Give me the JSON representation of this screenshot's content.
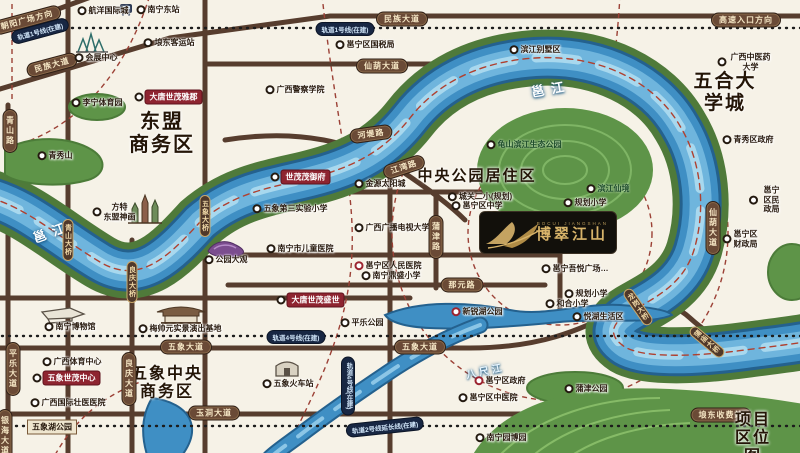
{
  "map": {
    "title": "项目区位图",
    "logo": {
      "sub": "BOCUI JIANGSHAN",
      "title": "博翠江山"
    },
    "colors": {
      "river": "#3f8fc4",
      "bank_green": "#4f7a3a",
      "road_brown": "#573d2e",
      "metro_navy": "#182743",
      "project_red": "#8e2430",
      "dash_maroon": "#9c4136",
      "logo_gold": "#d8b46a",
      "paper": "#f6f2e7"
    },
    "labels": [
      {
        "n": "pill-chaoyang-square-direction",
        "t": "朝阳广场方向",
        "x": 27,
        "y": 20,
        "k": "roadpill",
        "ro": -15
      },
      {
        "n": "pill-metro-line1-a",
        "t": "轨道1号线(在建)",
        "x": 40,
        "y": 31,
        "k": "navypill",
        "ro": -15
      },
      {
        "n": "poi-hangyang-intl-city",
        "t": "航洋国际城",
        "x": 103,
        "y": 11,
        "k": "poi"
      },
      {
        "n": "poi-nanning-east-station",
        "t": "南宁东站",
        "x": 158,
        "y": 10,
        "k": "poi"
      },
      {
        "n": "pill-minzu-avenue-a",
        "t": "民族大道",
        "x": 52,
        "y": 65,
        "k": "roadpill",
        "ro": -15
      },
      {
        "n": "poi-langdong-bus-station",
        "t": "埌东客运站",
        "x": 169,
        "y": 43,
        "k": "poi"
      },
      {
        "n": "poi-convention-center",
        "t": "会展中心",
        "x": 96,
        "y": 58,
        "k": "poi"
      },
      {
        "n": "pill-qingshan-road",
        "t": "青山路",
        "x": 10,
        "y": 131,
        "k": "roadpill-v"
      },
      {
        "n": "poi-qingxiu-mountain",
        "t": "青秀山",
        "x": 55,
        "y": 156,
        "k": "poi"
      },
      {
        "n": "poi-lining-sports-park",
        "t": "李宁体育园",
        "x": 97,
        "y": 103,
        "k": "poi"
      },
      {
        "n": "project-datang-shimao-yajun",
        "t": "大唐世茂雅郡",
        "x": 168,
        "y": 97,
        "k": "redbox"
      },
      {
        "n": "area-dongmeng-business-district",
        "t": "东盟\n商务区",
        "x": 162,
        "y": 134,
        "k": "big",
        "s": 20
      },
      {
        "n": "pill-metro-line1-b",
        "t": "轨道1号线(在建)",
        "x": 345,
        "y": 29,
        "k": "navypill"
      },
      {
        "n": "pill-minzu-avenue-b",
        "t": "民族大道",
        "x": 402,
        "y": 19,
        "k": "roadpill"
      },
      {
        "n": "poi-yongning-tax-bureau",
        "t": "邕宁区国税局",
        "x": 365,
        "y": 45,
        "k": "poi"
      },
      {
        "n": "poi-binjiang-villa-area",
        "t": "滨江别墅区",
        "x": 535,
        "y": 50,
        "k": "poi"
      },
      {
        "n": "pill-highway-entrance-direction",
        "t": "高速入口方向",
        "x": 746,
        "y": 20,
        "k": "roadpill"
      },
      {
        "n": "poi-gx-tcm-university",
        "t": "广西中医药大学",
        "x": 745,
        "y": 62,
        "k": "poi"
      },
      {
        "n": "area-wuhe-university-town",
        "t": "五合大学城",
        "x": 725,
        "y": 93,
        "k": "big",
        "s": 19
      },
      {
        "n": "poi-qingxiu-district-gov",
        "t": "青秀区政府",
        "x": 748,
        "y": 140,
        "k": "poi"
      },
      {
        "n": "pill-xianhu-avenue-h",
        "t": "仙葫大道",
        "x": 382,
        "y": 66,
        "k": "roadpill"
      },
      {
        "n": "poi-gx-police-college",
        "t": "广西警察学院",
        "x": 295,
        "y": 90,
        "k": "poi"
      },
      {
        "n": "river-label-yongjiang-a",
        "t": "邕江",
        "x": 52,
        "y": 231,
        "k": "river",
        "ro": -20
      },
      {
        "n": "river-label-yongjiang-b",
        "t": "邕江",
        "x": 551,
        "y": 88,
        "k": "river",
        "ro": -10
      },
      {
        "n": "bridge-qingshan",
        "t": "青山大桥",
        "x": 68,
        "y": 240,
        "k": "bridge"
      },
      {
        "n": "bridge-wuxiang",
        "t": "五象大桥",
        "x": 205,
        "y": 216,
        "k": "bridge"
      },
      {
        "n": "bridge-liangqing",
        "t": "良庆大桥",
        "x": 132,
        "y": 282,
        "k": "bridge"
      },
      {
        "n": "poi-fangte-asean-legend",
        "t": "方特\n东盟神画",
        "x": 114,
        "y": 212,
        "k": "poi"
      },
      {
        "n": "poi-jinyuan-sun-city",
        "t": "金源太阳城",
        "x": 380,
        "y": 184,
        "k": "poi"
      },
      {
        "n": "project-shimao-maoyufu",
        "t": "世茂茂御府",
        "x": 300,
        "y": 177,
        "k": "redbox"
      },
      {
        "n": "poi-wuxiang-no3-experimental-primary",
        "t": "五象第三实验小学",
        "x": 290,
        "y": 209,
        "k": "poi"
      },
      {
        "n": "area-central-park-residential",
        "t": "中央公园居住区",
        "x": 477,
        "y": 177,
        "k": "big",
        "s": 15
      },
      {
        "n": "poi-chengguan-2nd-primary",
        "t": "城关二小(规划)",
        "x": 480,
        "y": 197,
        "k": "poi"
      },
      {
        "n": "poi-yongning-middle-school",
        "t": "邕宁区中学",
        "x": 477,
        "y": 206,
        "k": "poi"
      },
      {
        "n": "poi-planned-school-1",
        "t": "规划小学",
        "x": 585,
        "y": 203,
        "k": "poi"
      },
      {
        "n": "poi-binjiang-scenic",
        "t": "滨江仙境",
        "x": 608,
        "y": 189,
        "k": "green"
      },
      {
        "n": "poi-guishan-riverside-eco-park",
        "t": "龟山滨江生态公园",
        "x": 524,
        "y": 145,
        "k": "green"
      },
      {
        "n": "poi-gx-broadcast-tv-university",
        "t": "广西广播电视大学",
        "x": 392,
        "y": 228,
        "k": "poi"
      },
      {
        "n": "poi-gongyuan-daguan",
        "t": "公园大观",
        "x": 226,
        "y": 260,
        "k": "poi"
      },
      {
        "n": "poi-children-hospital",
        "t": "南宁市儿童医院",
        "x": 300,
        "y": 249,
        "k": "poi"
      },
      {
        "n": "poi-yongning-people-hospital",
        "t": "邕宁区人民医院",
        "x": 388,
        "y": 266,
        "k": "poi",
        "r": "red"
      },
      {
        "n": "poi-dingsheng-primary",
        "t": "南宁鼎盛小学",
        "x": 391,
        "y": 276,
        "k": "poi"
      },
      {
        "n": "poi-yongning-wuyue-plaza",
        "t": "邕宁吾悦广场…",
        "x": 575,
        "y": 269,
        "k": "poi"
      },
      {
        "n": "poi-yongning-civil-affairs",
        "t": "邕宁区民政局",
        "x": 766,
        "y": 200,
        "k": "poi"
      },
      {
        "n": "poi-yongning-finance-bureau",
        "t": "邕宁区\n财政局",
        "x": 740,
        "y": 239,
        "k": "poi"
      },
      {
        "n": "pill-jiangwan-road",
        "t": "江湾路",
        "x": 404,
        "y": 167,
        "k": "roadpill",
        "ro": -18
      },
      {
        "n": "pill-hedi-road",
        "t": "河堤路",
        "x": 371,
        "y": 134,
        "k": "roadpill",
        "ro": -8
      },
      {
        "n": "pill-xianhu-avenue-v",
        "t": "仙葫大道",
        "x": 713,
        "y": 228,
        "k": "roadpill-v"
      },
      {
        "n": "pill-pujin-road",
        "t": "蒲津路",
        "x": 436,
        "y": 237,
        "k": "roadpill-v"
      },
      {
        "n": "pill-nayuan-road",
        "t": "那元路",
        "x": 462,
        "y": 285,
        "k": "roadpill"
      },
      {
        "n": "poi-planned-school-2",
        "t": "规划小学",
        "x": 586,
        "y": 294,
        "k": "poi"
      },
      {
        "n": "poi-hehe-primary",
        "t": "和合小学",
        "x": 567,
        "y": 304,
        "k": "poi"
      },
      {
        "n": "pill-metro-line4",
        "t": "轨道4号线(在建)",
        "x": 296,
        "y": 337,
        "k": "navypill"
      },
      {
        "n": "poi-yuehu-life-area",
        "t": "悦湖生活区",
        "x": 598,
        "y": 317,
        "k": "poi"
      },
      {
        "n": "project-datang-shimao-shengshi",
        "t": "大唐世茂盛世",
        "x": 310,
        "y": 300,
        "k": "redbox"
      },
      {
        "n": "poi-pingle-park",
        "t": "平乐公园",
        "x": 362,
        "y": 323,
        "k": "poi"
      },
      {
        "n": "poi-xinrui-lake-park",
        "t": "新锐湖公园",
        "x": 477,
        "y": 312,
        "k": "poi",
        "r": "red"
      },
      {
        "n": "pill-wuxiang-avenue-a",
        "t": "五象大道",
        "x": 186,
        "y": 347,
        "k": "roadpill"
      },
      {
        "n": "pill-wuxiang-avenue-b",
        "t": "五象大道",
        "x": 420,
        "y": 347,
        "k": "roadpill"
      },
      {
        "n": "river-label-bachijiang",
        "t": "八尺江",
        "x": 485,
        "y": 370,
        "k": "river-sm",
        "ro": -12
      },
      {
        "n": "poi-yongning-district-gov",
        "t": "邕宁区政府",
        "x": 500,
        "y": 381,
        "k": "poi",
        "r": "red"
      },
      {
        "n": "poi-yongning-tcm-hospital",
        "t": "邕宁区中医院",
        "x": 488,
        "y": 398,
        "k": "poi"
      },
      {
        "n": "pill-metro-line4-v",
        "t": "轨道4号线(在建)",
        "x": 348,
        "y": 386,
        "k": "navypill-v"
      },
      {
        "n": "poi-wuxiang-railway-station",
        "t": "五象火车站",
        "x": 288,
        "y": 384,
        "k": "poi"
      },
      {
        "n": "poi-nanning-museum",
        "t": "南宁博物馆",
        "x": 70,
        "y": 327,
        "k": "poi"
      },
      {
        "n": "poi-meishuaiyuan-show-base",
        "t": "梅帅元实景演出基地",
        "x": 180,
        "y": 329,
        "k": "poi"
      },
      {
        "n": "poi-gx-sports-center",
        "t": "广西体育中心",
        "x": 72,
        "y": 362,
        "k": "poi"
      },
      {
        "n": "project-wuxiang-shimao-center",
        "t": "五象世茂中心",
        "x": 66,
        "y": 378,
        "k": "redbox"
      },
      {
        "n": "area-wuxiang-central-cbd",
        "t": "五象中央\n商务区",
        "x": 167,
        "y": 384,
        "k": "big",
        "s": 16
      },
      {
        "n": "poi-gx-intl-zhuang-hospital",
        "t": "广西国际壮医医院",
        "x": 68,
        "y": 403,
        "k": "poi"
      },
      {
        "n": "pill-yudong-avenue",
        "t": "玉洞大道",
        "x": 214,
        "y": 413,
        "k": "roadpill"
      },
      {
        "n": "box-wuxianghu-park",
        "t": "五象湖公园",
        "x": 52,
        "y": 427,
        "k": "box"
      },
      {
        "n": "pill-pingle-avenue",
        "t": "平乐大道",
        "x": 13,
        "y": 369,
        "k": "roadpill-v"
      },
      {
        "n": "pill-liangqing-avenue",
        "t": "良庆大道",
        "x": 129,
        "y": 379,
        "k": "roadpill-v"
      },
      {
        "n": "pill-yinhai-avenue",
        "t": "银海大道",
        "x": 5,
        "y": 436,
        "k": "roadpill-v"
      },
      {
        "n": "pill-metro-line2-ext",
        "t": "轨道2号线延长线(在建)",
        "x": 385,
        "y": 427,
        "k": "navypill",
        "ro": -6
      },
      {
        "n": "poi-pujin-park",
        "t": "蒲津公园",
        "x": 586,
        "y": 389,
        "k": "poi"
      },
      {
        "n": "pill-langdong-toll-station",
        "t": "埌东收费站",
        "x": 721,
        "y": 415,
        "k": "roadpill"
      },
      {
        "n": "poi-nanning-garden-expo",
        "t": "南宁园博园",
        "x": 501,
        "y": 438,
        "k": "poi"
      },
      {
        "n": "map-title",
        "t": "项目区位图",
        "x": 753,
        "y": 439,
        "k": "big",
        "s": 16
      },
      {
        "n": "bridge-longgang",
        "t": "龙岗大桥",
        "x": 638,
        "y": 307,
        "k": "bridge",
        "ro": -35
      },
      {
        "n": "bridge-pumiao",
        "t": "蒲庙大桥",
        "x": 707,
        "y": 342,
        "k": "bridge",
        "ro": -50
      }
    ]
  }
}
